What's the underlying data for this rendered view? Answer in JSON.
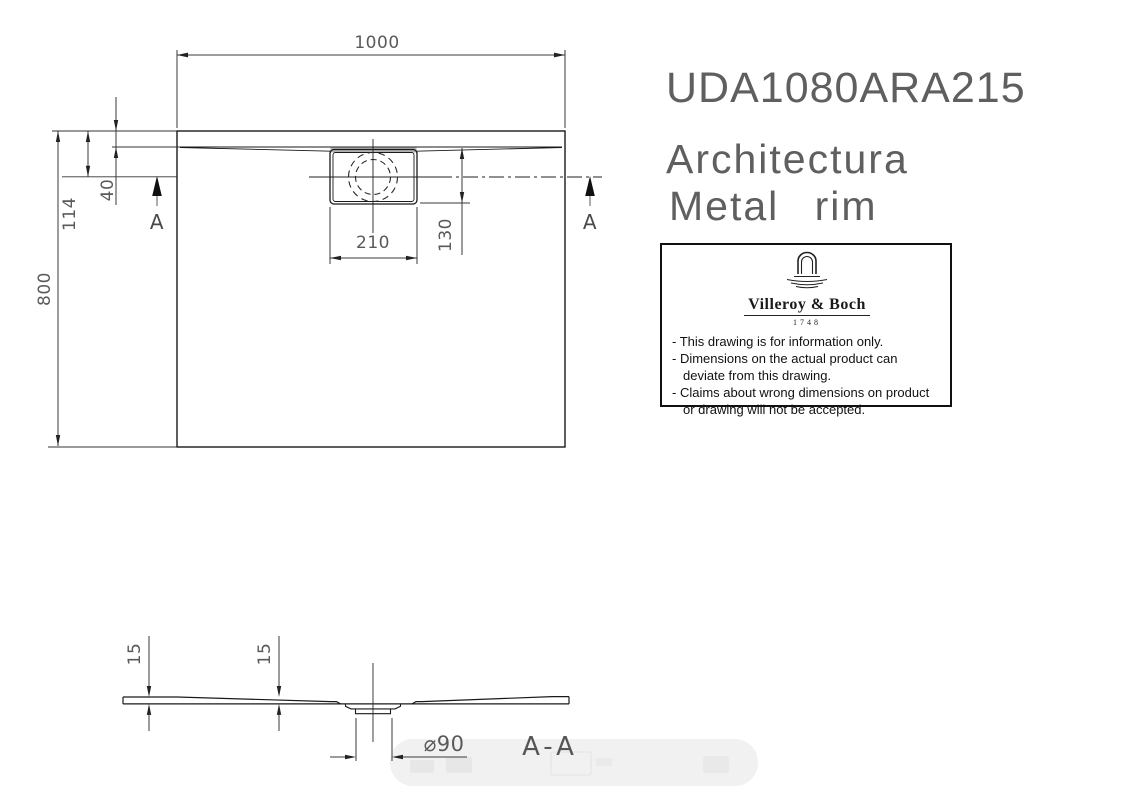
{
  "product": {
    "code": "UDA1080ARA215",
    "series": "Architectura",
    "variant": "Metal rim"
  },
  "plan_view": {
    "dim_width": "1000",
    "dim_height": "800",
    "dim_drain_center_from_top": "114",
    "dim_rim_offset": "40",
    "dim_drain_box_width": "210",
    "dim_drain_box_height": "130",
    "section_marker_left": "A",
    "section_marker_right": "A"
  },
  "section_view": {
    "label": "A-A",
    "dim_thickness_left": "15",
    "dim_thickness_right": "15",
    "dim_drain_diameter": "⌀90"
  },
  "info_box": {
    "brand": "Villeroy & Boch",
    "established": "1748",
    "notes": [
      "- This drawing is for information only.",
      "- Dimensions on the actual product can deviate from this drawing.",
      "- Claims about wrong dimensions on product or drawing will not be accepted."
    ]
  },
  "colors": {
    "object_line": "#1a1a1a",
    "dimension_line": "#3a3a3a",
    "drain_shade": "#b3b3b3",
    "watermark": "#f1f1f1"
  }
}
